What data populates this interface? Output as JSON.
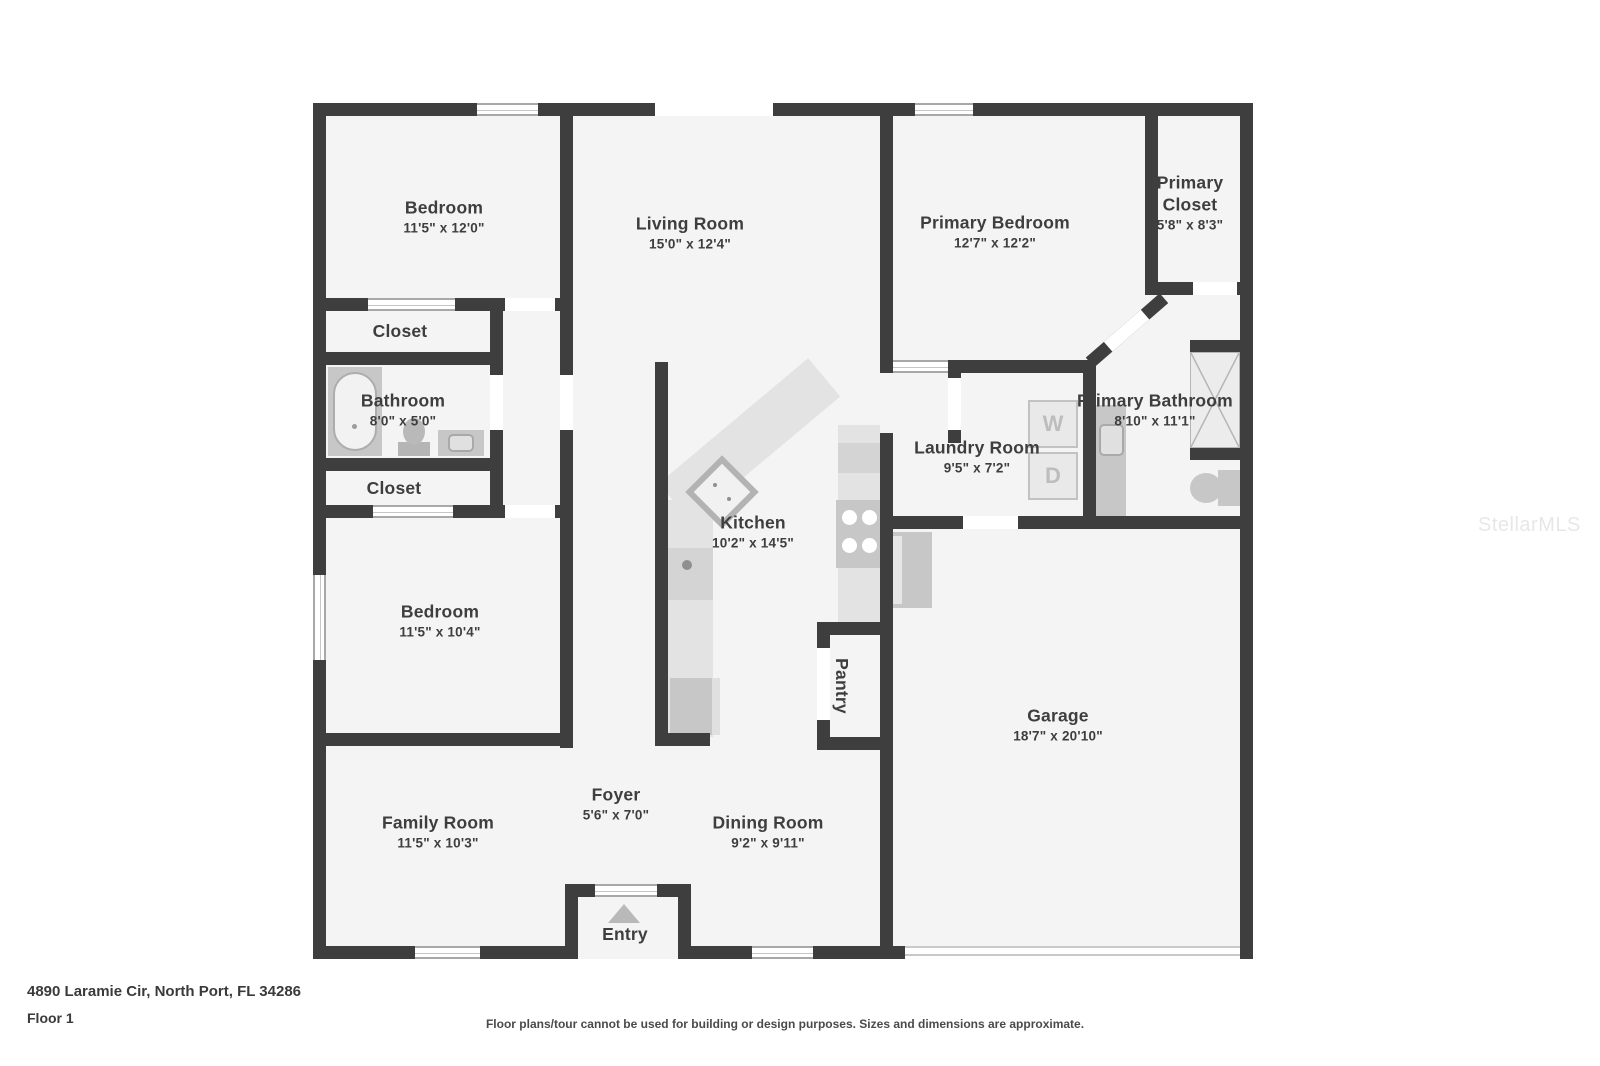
{
  "plan": {
    "rooms": [
      {
        "name": "Bedroom",
        "dims": "11'5\" x 12'0\""
      },
      {
        "name": "Living Room",
        "dims": "15'0\" x 12'4\""
      },
      {
        "name": "Primary Bedroom",
        "dims": "12'7\" x 12'2\""
      },
      {
        "name": "Primary Closet",
        "dims": "5'8\" x 8'3\""
      },
      {
        "name": "Closet"
      },
      {
        "name": "Bathroom",
        "dims": "8'0\" x 5'0\""
      },
      {
        "name": "Closet"
      },
      {
        "name": "Primary Bathroom",
        "dims": "8'10\" x 11'1\""
      },
      {
        "name": "Laundry Room",
        "dims": "9'5\" x 7'2\""
      },
      {
        "name": "Bedroom",
        "dims": "11'5\" x 10'4\""
      },
      {
        "name": "Kitchen",
        "dims": "10'2\" x 14'5\""
      },
      {
        "name": "Pantry"
      },
      {
        "name": "Garage",
        "dims": "18'7\" x 20'10\""
      },
      {
        "name": "Family Room",
        "dims": "11'5\" x 10'3\""
      },
      {
        "name": "Foyer",
        "dims": "5'6\" x 7'0\""
      },
      {
        "name": "Dining Room",
        "dims": "9'2\" x 9'11\""
      },
      {
        "name": "Entry"
      }
    ],
    "appliances": {
      "washer": "W",
      "dryer": "D"
    },
    "footer": {
      "address": "4890 Laramie Cir, North Port, FL 34286",
      "floor_label": "Floor 1",
      "disclaimer": "Floor plans/tour cannot be used for building or design purposes. Sizes and dimensions are approximate."
    },
    "watermark": "StellarMLS",
    "colors": {
      "wall": "#3e3e3e",
      "floor": "#f4f4f4",
      "fixture": "#c7c7c7",
      "counter": "#e3e3e3",
      "window_frame": "#a8a8a8",
      "label_text": "#3e3e3e",
      "watermark": "#e7e7e7"
    }
  }
}
